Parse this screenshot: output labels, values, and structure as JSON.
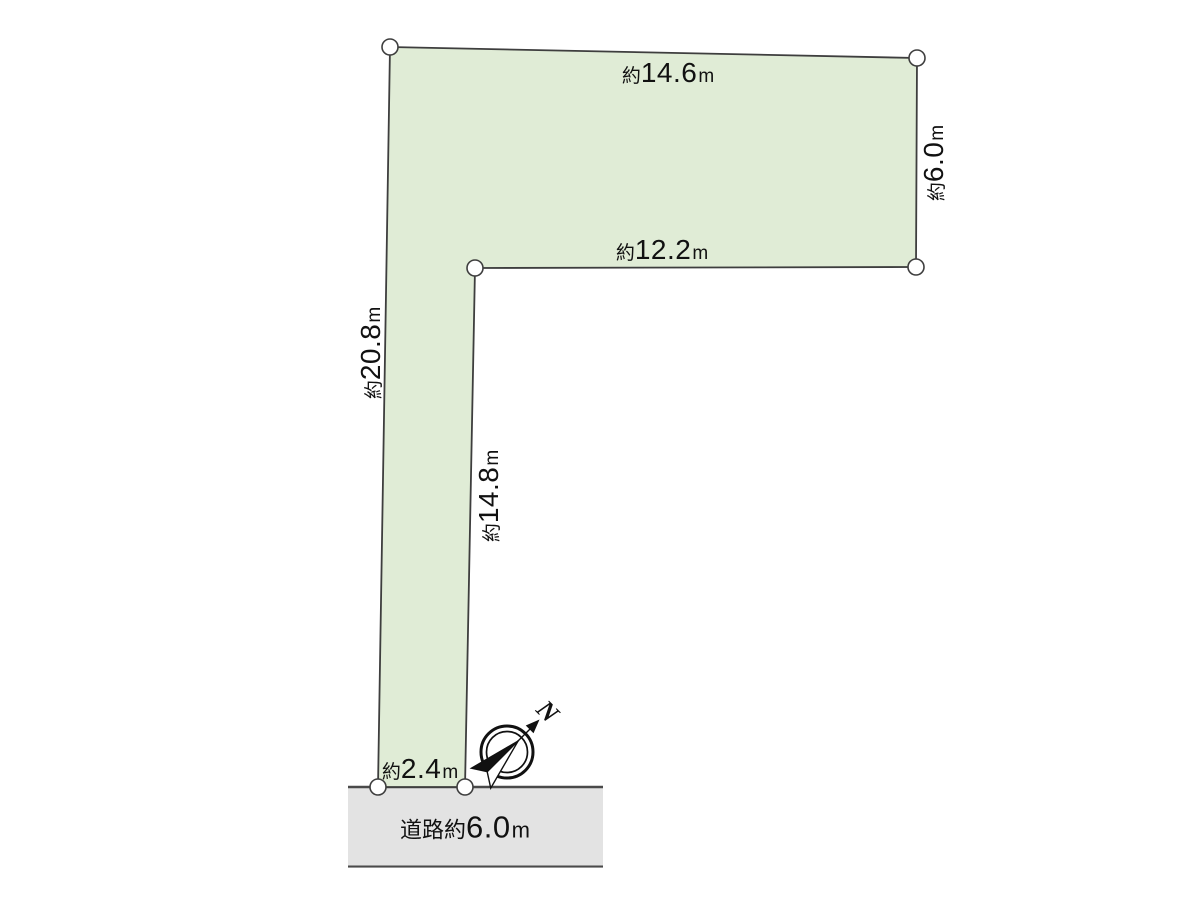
{
  "dimensions": {
    "top_edge": {
      "prefix": "約",
      "value": "14.6",
      "unit": "m"
    },
    "right_edge": {
      "prefix": "約",
      "value": "6.0",
      "unit": "m"
    },
    "inner_top_edge": {
      "prefix": "約",
      "value": "12.2",
      "unit": "m"
    },
    "left_edge": {
      "prefix": "約",
      "value": "20.8",
      "unit": "m"
    },
    "inner_vertical_edge": {
      "prefix": "約",
      "value": "14.8",
      "unit": "m"
    },
    "frontage_edge": {
      "prefix": "約",
      "value": "2.4",
      "unit": "m"
    }
  },
  "road": {
    "prefix": "道路約",
    "value": "6.0",
    "unit": "m"
  },
  "compass": {
    "north_label": "N"
  },
  "colors": {
    "plot_fill": "#e0ecd6",
    "line": "#3e3e3e",
    "road_fill": "#e3e3e3",
    "road_line": "#4a4a4a",
    "text": "#111111",
    "bg": "#ffffff"
  }
}
